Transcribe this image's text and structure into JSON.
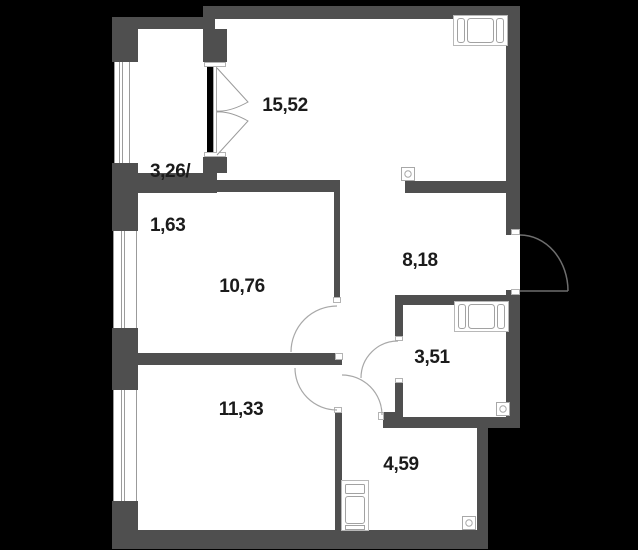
{
  "title": "apartment-floor-plan",
  "colors": {
    "background": "#000000",
    "wall": "#4f4f4f",
    "floor": "#ffffff",
    "line": "#a3a3a3",
    "text": "#1b1b1b"
  },
  "rooms": {
    "living": {
      "area": "15,52"
    },
    "balcony": {
      "area_line1": "3,26/",
      "area_line2": "1,63"
    },
    "bedroom1": {
      "area": "10,76"
    },
    "hallway": {
      "area": "8,18"
    },
    "bathroom": {
      "area": "3,51"
    },
    "bedroom2": {
      "area": "11,33"
    },
    "kitchen": {
      "area": "4,59"
    }
  },
  "icons": {
    "bed": "bed-icon",
    "bathtub": "bathtub-icon",
    "washing_machine": "washing-machine-icon",
    "vent": "vent-icon",
    "window": "window-symbol",
    "door_swing": "door-swing-arc"
  }
}
